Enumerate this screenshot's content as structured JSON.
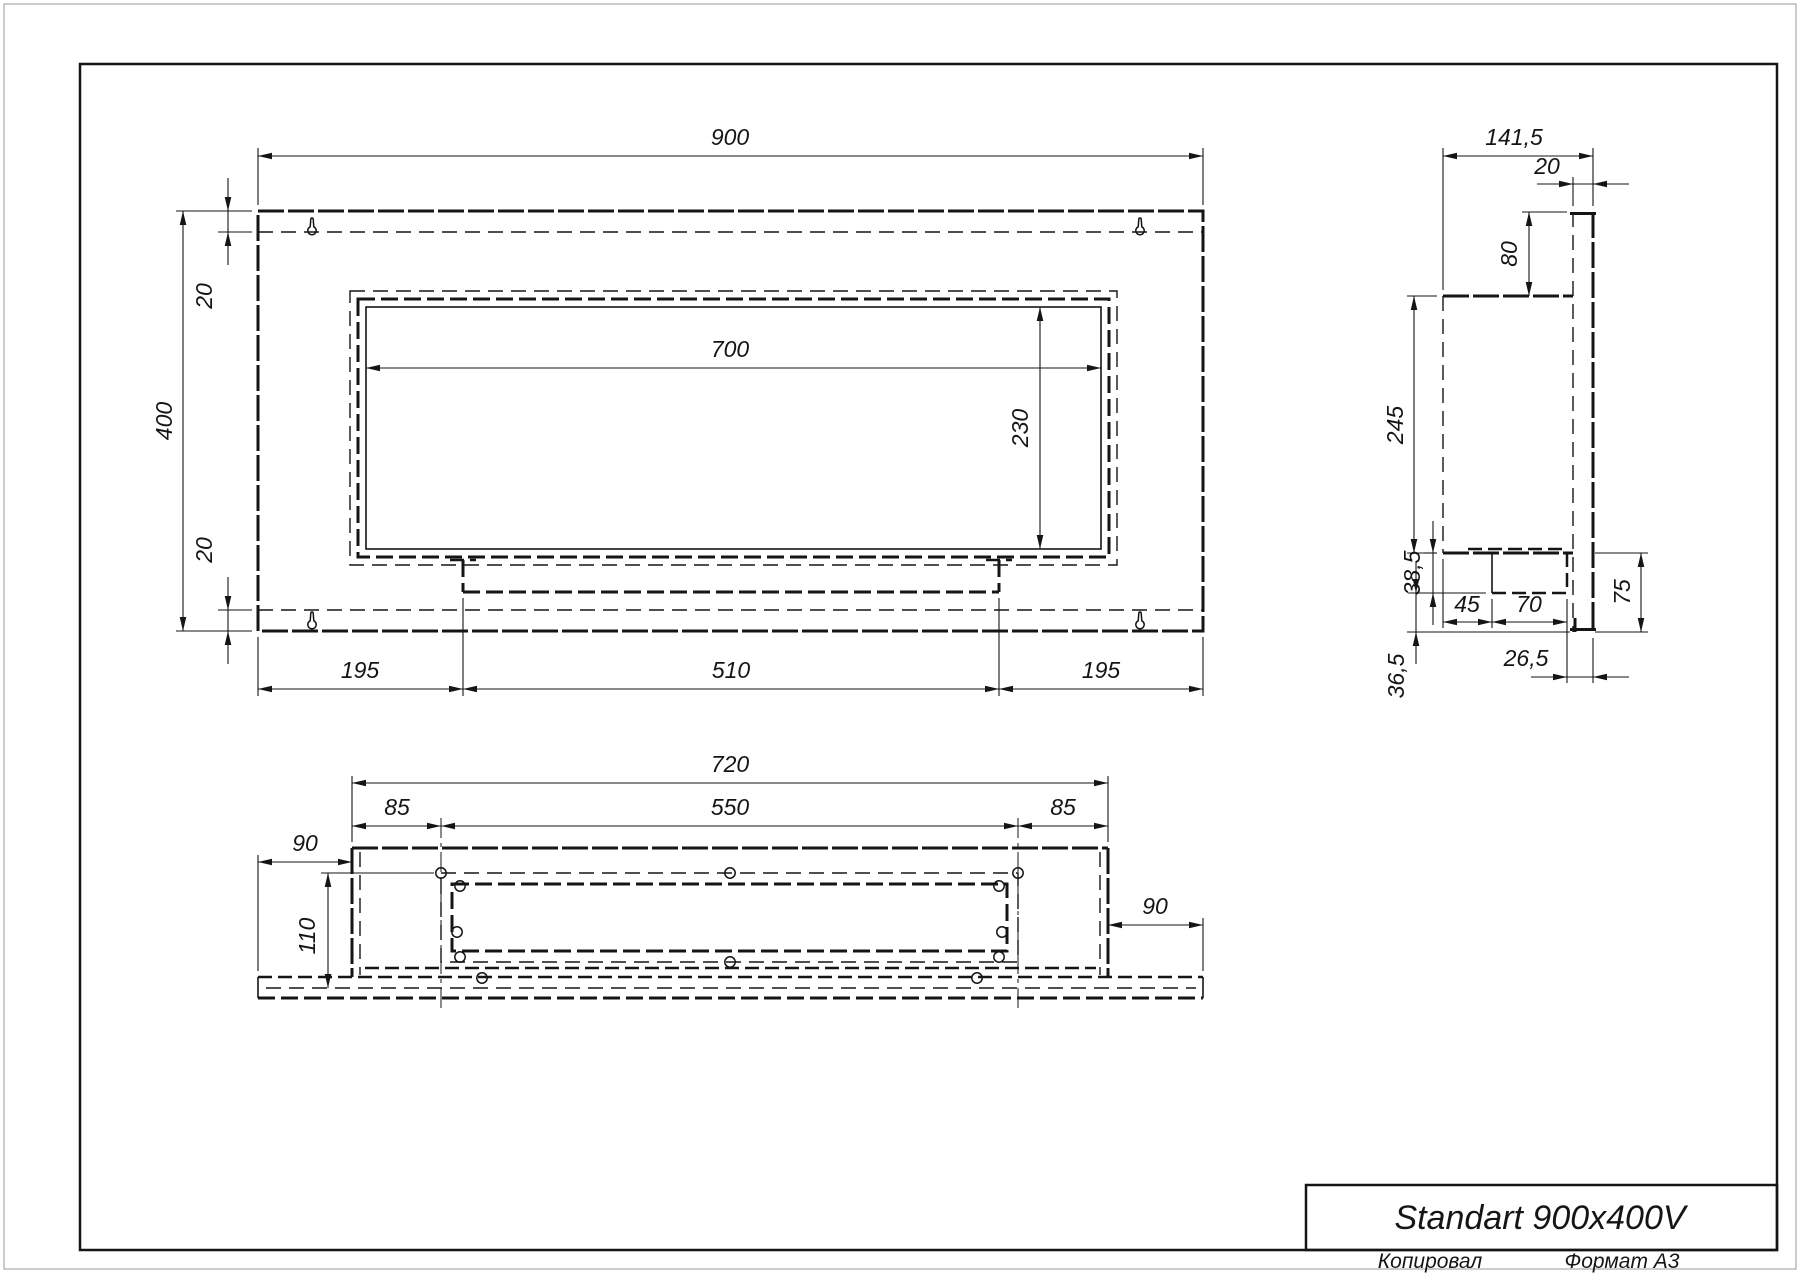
{
  "colors": {
    "ink": "#151515",
    "paper": "#ffffff"
  },
  "title_block": {
    "model": "Standart 900x400V"
  },
  "footer": {
    "copied_label": "Копировал",
    "format_label": "Формат A3"
  },
  "front_view": {
    "overall_width": "900",
    "overall_height": "400",
    "top_flange": "20",
    "bottom_flange": "20",
    "opening_width": "700",
    "opening_height": "230",
    "left_margin": "195",
    "burner_width": "510",
    "right_margin": "195"
  },
  "side_view": {
    "overall_depth": "141,5",
    "back_plate_thickness": "20",
    "top_drop": "80",
    "body_height": "245",
    "tray_depth": "38,5",
    "tray_offset": "45",
    "tray_width": "70",
    "tray_to_back_gap": "26,5",
    "below_tray": "36,5",
    "back_below_shelf": "75"
  },
  "bottom_view": {
    "body_width": "720",
    "left_inset": "85",
    "slot_width": "550",
    "right_inset": "85",
    "left_step": "90",
    "cavity_depth": "110",
    "right_step": "90"
  }
}
